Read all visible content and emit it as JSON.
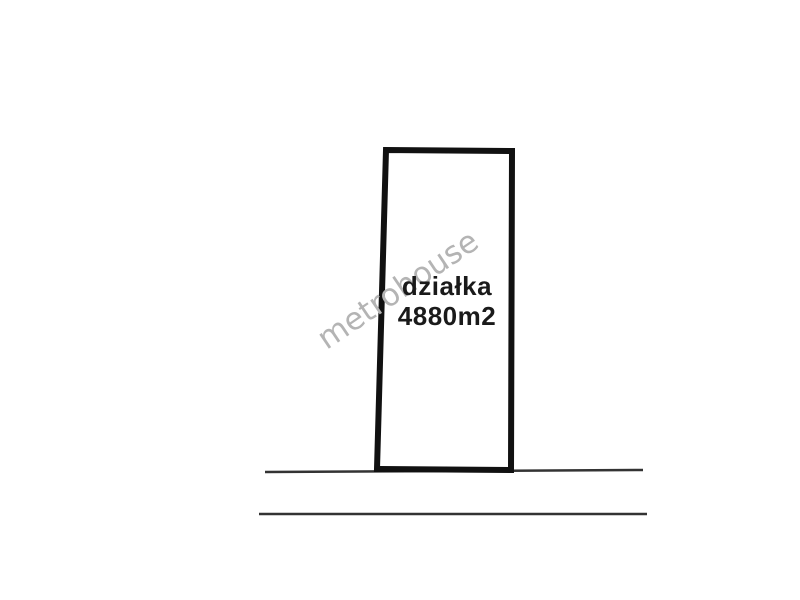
{
  "plot": {
    "label_line1": "działka",
    "label_line2": "4880m2"
  },
  "watermark": {
    "text": "metrohouse"
  },
  "colors": {
    "background": "#ffffff",
    "plot_border": "#111111",
    "plot_fill": "#ffffff",
    "label_text": "#1a1a1a",
    "watermark_text": "#b4b4b4",
    "road_line": "#333333"
  }
}
